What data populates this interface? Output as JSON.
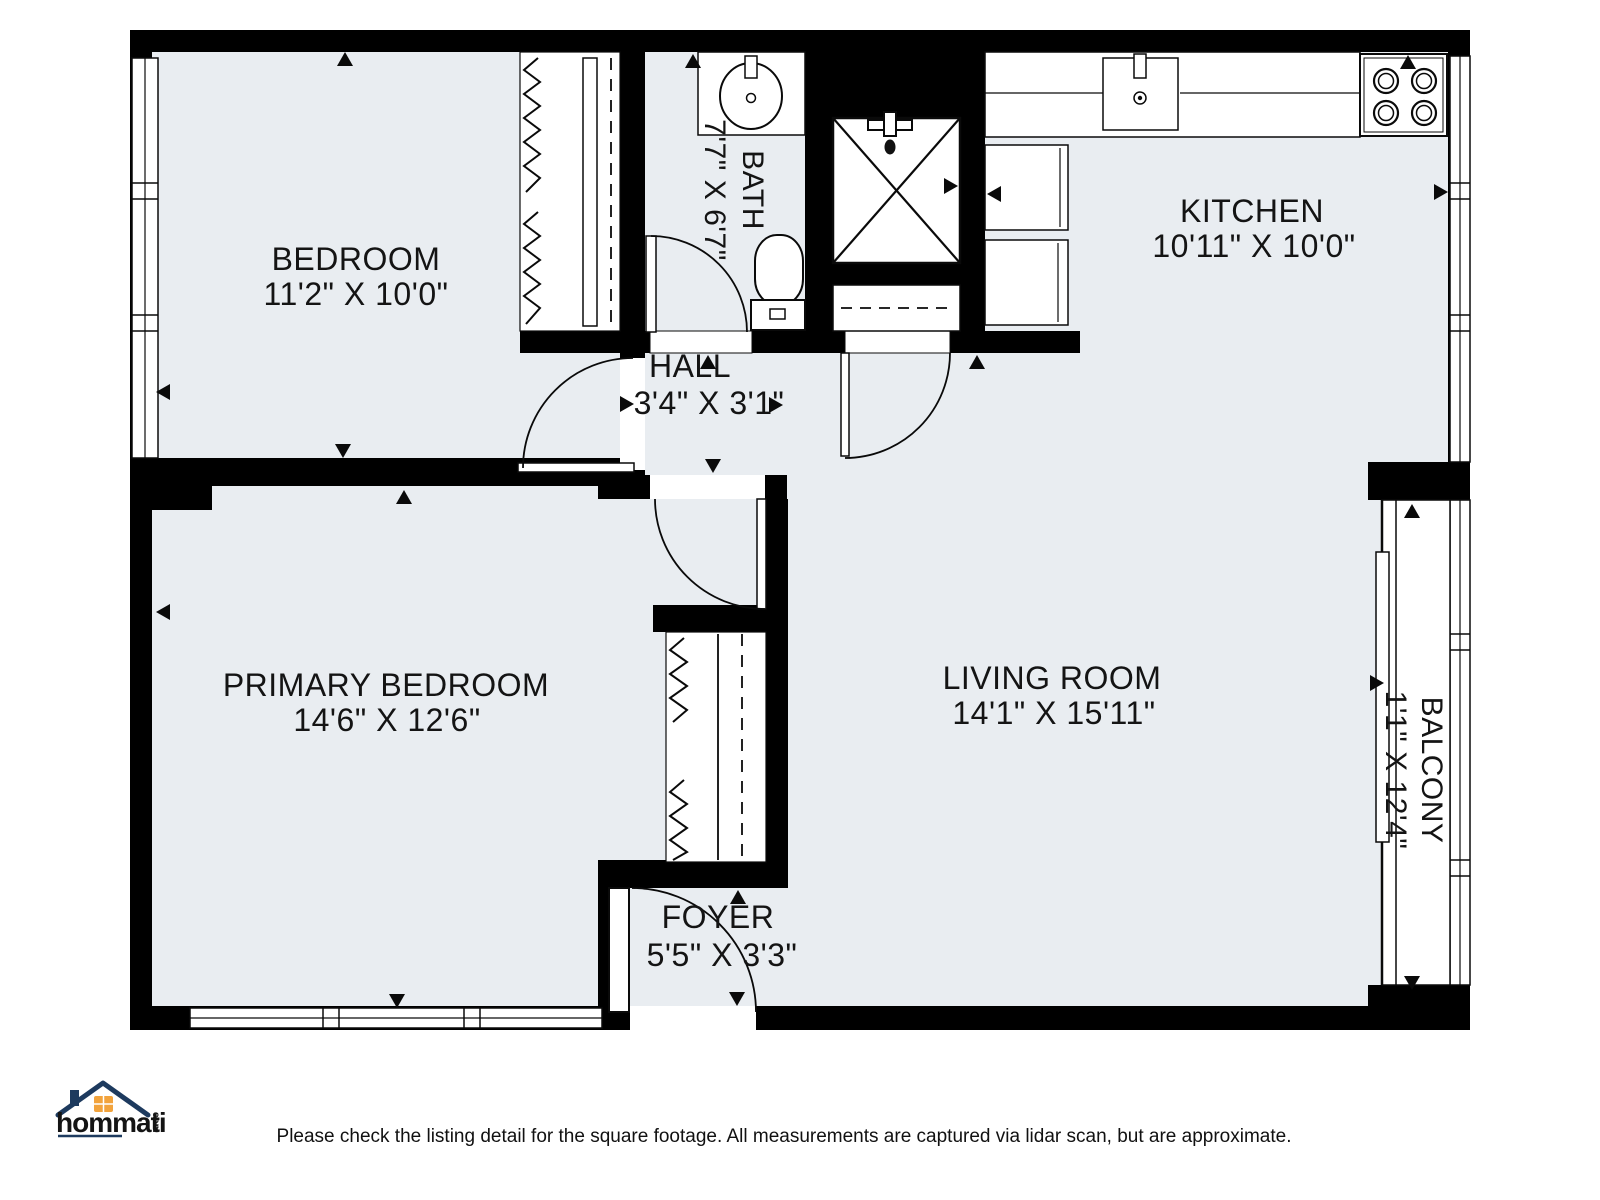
{
  "colors": {
    "room_fill": "#e9edf1",
    "wall": "#000000",
    "line": "#0a0a0a",
    "logo_navy": "#1d3a5e",
    "logo_orange": "#f2a33c"
  },
  "plan": {
    "rooms": [
      {
        "id": "bedroom",
        "name": "BEDROOM",
        "dims": "11'2\" X 10'0\""
      },
      {
        "id": "bath",
        "name": "BATH",
        "dims": "7'7\" X 6'7\""
      },
      {
        "id": "kitchen",
        "name": "KITCHEN",
        "dims": "10'11\" X 10'0\""
      },
      {
        "id": "hall",
        "name": "HALL",
        "dims": "3'4\" X 3'1\""
      },
      {
        "id": "primary-bedroom",
        "name": "PRIMARY BEDROOM",
        "dims": "14'6\" X 12'6\""
      },
      {
        "id": "living-room",
        "name": "LIVING ROOM",
        "dims": "14'1\" X 15'11\""
      },
      {
        "id": "foyer",
        "name": "FOYER",
        "dims": "5'5\" X 3'3\""
      },
      {
        "id": "balcony",
        "name": "BALCONY",
        "dims": "1'1\" X 12'4\""
      }
    ]
  },
  "branding": {
    "logo_text": "hommati",
    "logo_suffix": "com"
  },
  "footer": {
    "disclaimer": "Please check the listing detail for the square footage. All measurements are captured via lidar scan, but are approximate."
  }
}
